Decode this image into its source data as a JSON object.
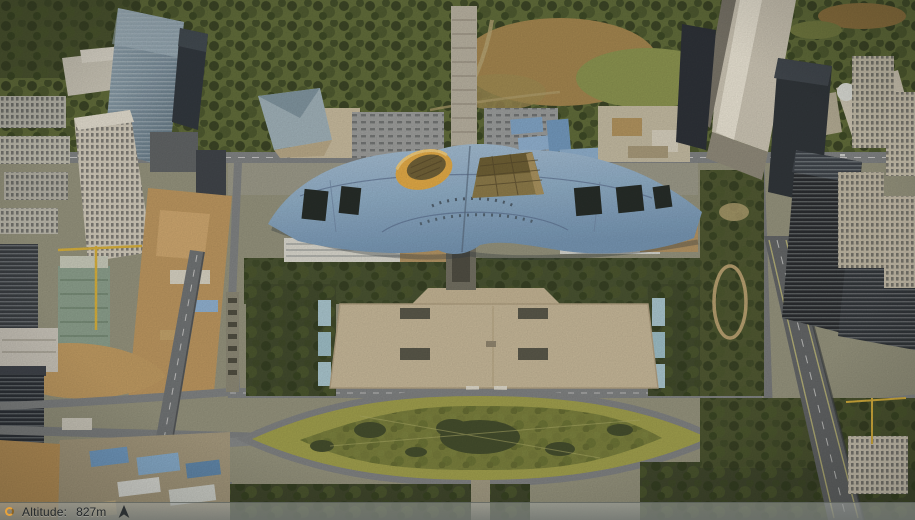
{
  "window": {
    "width": 915,
    "height": 520,
    "app_kind": "3d-aerial-map-viewer"
  },
  "status_bar": {
    "altitude_label": "Altitude:",
    "altitude_value": "827m",
    "left_icon": "loading-spinner-icon",
    "right_icon": "compass-north-icon"
  },
  "palette": {
    "accent_orange": "#e8a33c",
    "bar_text": "#24282a",
    "roof_blue": "#8fb0cd",
    "roof_blue_deep": "#7396b8",
    "crown_yellow": "#e5ac46",
    "pyramid_brown": "#8b7a49",
    "tree_green": "#3f4a2b",
    "park_green": "#5c6a38",
    "hill_tan": "#a3854e",
    "lawn_green": "#9fa04c",
    "lawn_green_deep": "#767e3c",
    "plaza_beige": "#c8ba9c",
    "road_gray": "#7e8285",
    "highway_gray": "#5f6468",
    "dirt_tan": "#bd9760",
    "shed_blue": "#7fa6cc",
    "tower_dark": "#262d36",
    "tower_light": "#cdc8b9",
    "glass_strip_blue": "#a9c9d4"
  },
  "scene": {
    "features": [
      "civic-center-wave-roof",
      "roof-crown-cylinder",
      "roof-pyramid",
      "civic-plaza",
      "lens-shaped-lawn",
      "north-park-hill",
      "elevated-highway-east",
      "construction-zone-west",
      "skyscraper-cluster-west",
      "skyscraper-cluster-east",
      "blue-roof-sheds"
    ]
  }
}
